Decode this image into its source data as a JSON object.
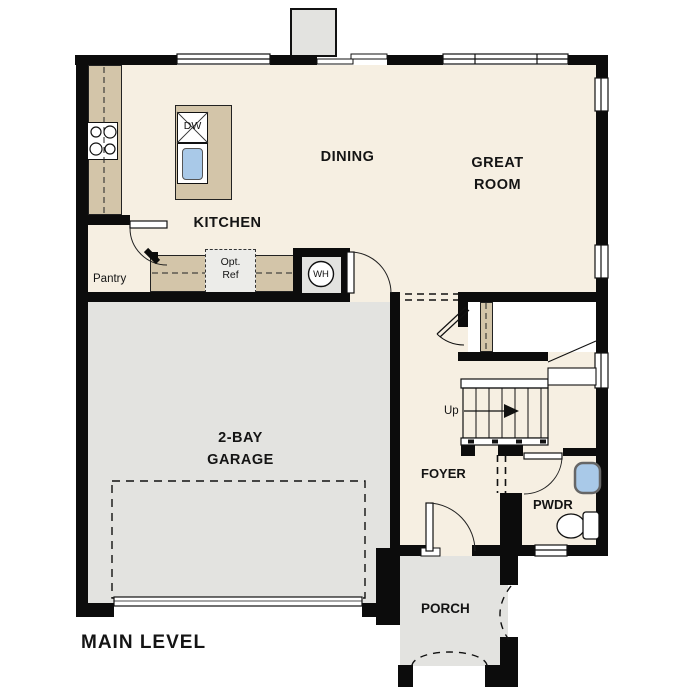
{
  "plan_title": {
    "label": "MAIN LEVEL"
  },
  "rooms": {
    "kitchen": {
      "label": "KITCHEN"
    },
    "dining": {
      "label": "DINING"
    },
    "great_room": {
      "label": "GREAT ROOM"
    },
    "garage": {
      "label": "2-BAY GARAGE"
    },
    "foyer": {
      "label": "FOYER"
    },
    "powder_room": {
      "label": "PWDR"
    },
    "porch": {
      "label": "PORCH"
    },
    "pantry": {
      "label": "Pantry"
    }
  },
  "fixtures": {
    "dishwasher": {
      "label": "DW"
    },
    "water_heater": {
      "label": "WH"
    },
    "optional_refrigerator": {
      "line1": "Opt.",
      "line2": "Ref"
    },
    "stairs": {
      "direction_label": "Up"
    }
  },
  "colors": {
    "floor_cream": "#f6efe2",
    "garage_gray": "#e3e3e0",
    "counter_tan": "#d3c5a9",
    "sink_blue": "#a9c9e8",
    "wall_black": "#0c0c0c"
  }
}
